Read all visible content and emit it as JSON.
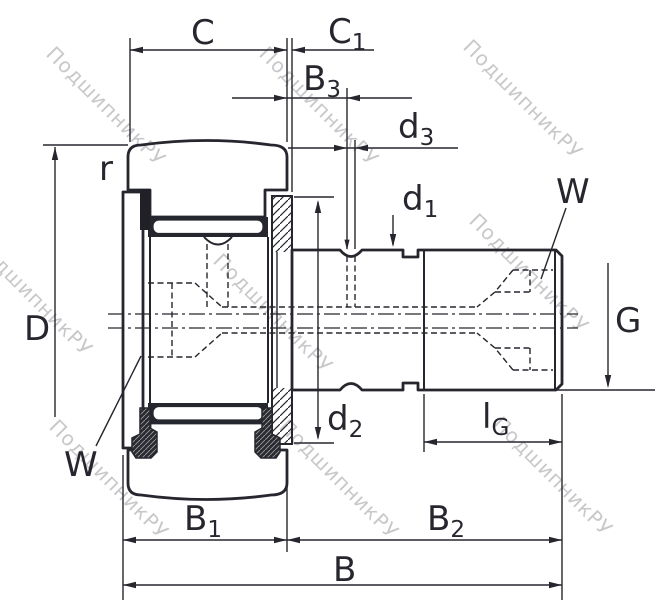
{
  "drawing": {
    "watermark": "ПодшипникРУ",
    "ink": "#26262e",
    "watermark_color": "#c8c8ca",
    "background": "#ffffff",
    "description": "Stud-type track roller (cam follower) bearing cross-section with dimension callouts"
  },
  "labels": {
    "c": {
      "main": "C",
      "sub": ""
    },
    "c1": {
      "main": "C",
      "sub": "1"
    },
    "b3": {
      "main": "B",
      "sub": "3"
    },
    "d3": {
      "main": "d",
      "sub": "3"
    },
    "d1": {
      "main": "d",
      "sub": "1"
    },
    "r": {
      "main": "r",
      "sub": ""
    },
    "w_right": {
      "main": "W",
      "sub": ""
    },
    "D": {
      "main": "D",
      "sub": ""
    },
    "G": {
      "main": "G",
      "sub": ""
    },
    "d2": {
      "main": "d",
      "sub": "2"
    },
    "lg": {
      "main": "l",
      "sub": "G"
    },
    "w_left": {
      "main": "W",
      "sub": ""
    },
    "b1": {
      "main": "B",
      "sub": "1"
    },
    "b2": {
      "main": "B",
      "sub": "2"
    },
    "b": {
      "main": "B",
      "sub": ""
    }
  }
}
